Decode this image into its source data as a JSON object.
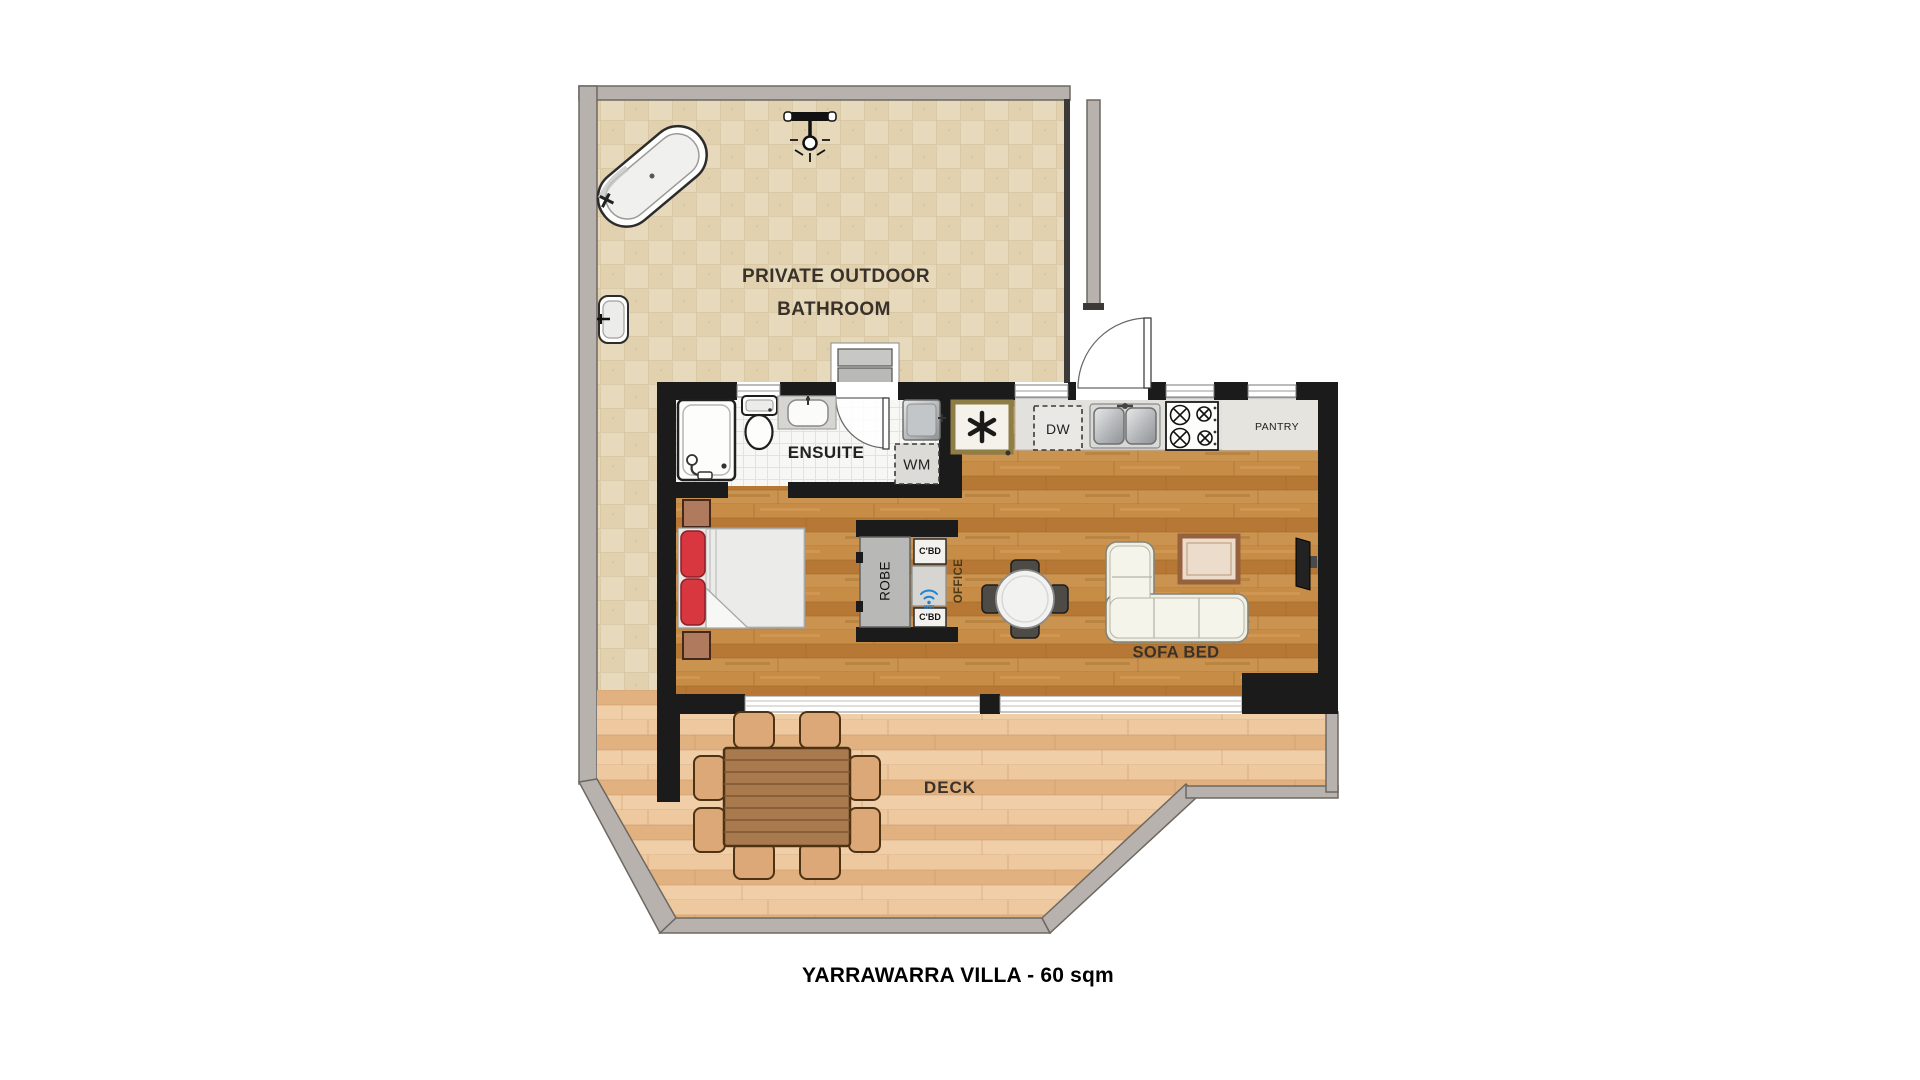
{
  "title": "YARRAWARRA VILLA - 60 sqm",
  "labels": {
    "outdoor_bathroom_line1": "PRIVATE OUTDOOR",
    "outdoor_bathroom_line2": "BATHROOM",
    "ensuite": "ENSUITE",
    "washing_machine": "WM",
    "dishwasher": "DW",
    "pantry": "PANTRY",
    "robe": "ROBE",
    "cupboard_top": "C'BD",
    "cupboard_bottom": "C'BD",
    "office": "OFFICE",
    "wifi": "WIFI",
    "sofa_bed": "SOFA BED",
    "deck": "DECK"
  },
  "colors": {
    "wall": "#1b1b1b",
    "fence_grey": "#b7b2ae",
    "bathroom_tile": "#e7d9bc",
    "interior_wood": "#bf8440",
    "deck_wood": "#e9bf92",
    "ensuite_floor": "#f7f7f5",
    "pillow_red": "#d8373f",
    "robe_grey": "#b8b8b6",
    "heater_trim": "#8f7d46",
    "wifi_blue": "#1a84d8",
    "sofa_cream": "#efefe2",
    "outdoor_timber": "#a87a4e"
  }
}
